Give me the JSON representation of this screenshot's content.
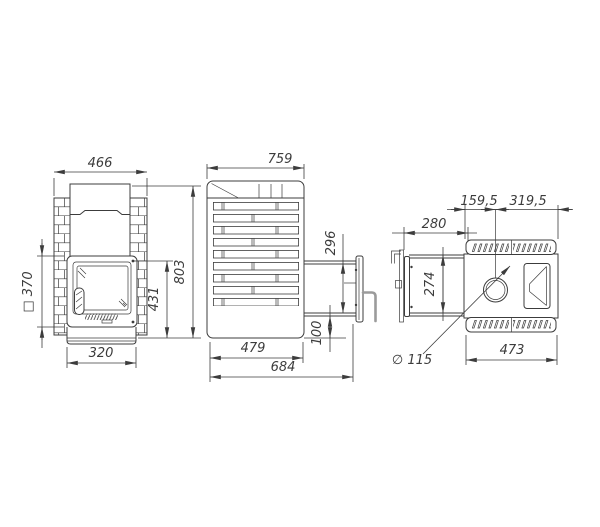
{
  "drawing": {
    "type": "sauna-stove-technical-drawing",
    "colors": {
      "line": "#3c3c3c",
      "handle": "#9b9b9b",
      "background": "#ffffff"
    },
    "views": {
      "front": {
        "dims": {
          "overall_width": "466",
          "door_square": "□ 370",
          "base_width": "320",
          "door_to_floor_height": "431",
          "overall_height": "803"
        }
      },
      "side": {
        "dims": {
          "overall_depth": "759",
          "tunnel_opening_height": "296",
          "bottom_offset": "100",
          "body_depth": "479",
          "total_depth_with_tunnel": "684"
        }
      },
      "top": {
        "dims": {
          "chimney_offset_front": "159,5",
          "chimney_offset_back": "319,5",
          "tunnel_length": "280",
          "tunnel_width": "274",
          "chimney_diameter": "∅ 115",
          "body_width": "473"
        }
      }
    }
  }
}
